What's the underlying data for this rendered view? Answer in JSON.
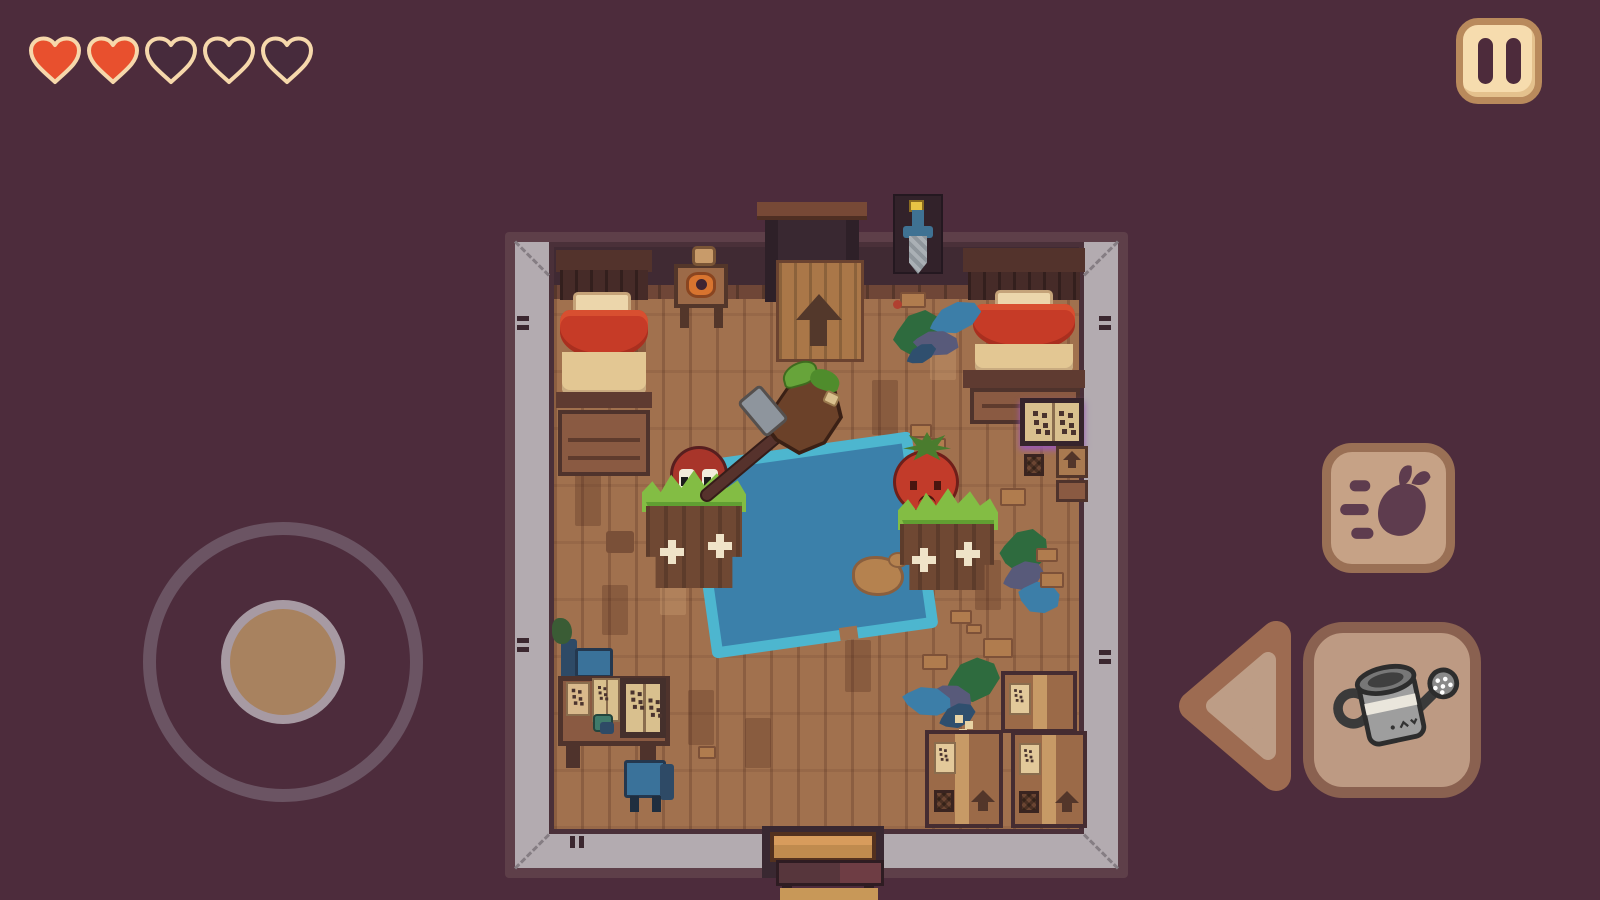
{
  "app": {
    "type": "pixel-art-game",
    "scene": "cottage-bedroom-top-down"
  },
  "hud": {
    "hearts": {
      "total": 5,
      "filled": 2,
      "filled_color": "#e8502e",
      "empty_color": "#472b3c",
      "outline_color": "#f6d8ab"
    },
    "pause": {
      "name": "pause-button",
      "icon": "pause-icon",
      "bg": "#f6dcae",
      "border": "#b98a5c",
      "glyph_color": "#4d2b3b"
    },
    "joystick": {
      "name": "virtual-joystick",
      "ring_color": "#6b5463",
      "knob_color": "#a8825f",
      "knob_ring_color": "#a79aa3"
    },
    "action_buttons": [
      {
        "name": "dash-button",
        "icon": "dash-radish-icon",
        "bg": "#c6a286",
        "border": "#9a7055",
        "icon_color": "#5e3c4e"
      },
      {
        "name": "back-button",
        "icon": "left-arrow-icon",
        "outer": "#9d6b51",
        "inner": "#bd9d86"
      },
      {
        "name": "water-button",
        "icon": "watering-can-icon",
        "bg": "#bd9a83",
        "border": "#8a6150"
      }
    ]
  },
  "palette": {
    "background": "#4d2c3c",
    "room_frame": "#5e3f49",
    "wall_band": "#b3abb0",
    "north_wall": "#402a33",
    "floor": "#a1714e",
    "pool_rim": "#4db6cf",
    "pool_water": "#3b80aa",
    "bed_blanket": "#c63b27",
    "bed_sheet": "#e3c793",
    "grass": "#83bd44",
    "pot": "#6f4833",
    "creature_red": "#a8352a",
    "tomato_red": "#c23b2a",
    "chair_blue": "#3a729a",
    "crate": "#9b6a48"
  },
  "scene": {
    "room": "wooden-bedroom",
    "objects": [
      "bed-left",
      "wardrobe",
      "nightstand-with-candle",
      "bed-right",
      "dresser",
      "spell-book-stand",
      "wall-sword-display",
      "top-doorway-with-ramp",
      "bottom-porch",
      "water-pool",
      "dirt-patch",
      "planter-with-red-sprout",
      "planter-with-tomato",
      "push-broom",
      "study-desk",
      "open-books",
      "blue-chair",
      "cardboard-crates",
      "weed-clusters",
      "floor-debris"
    ]
  }
}
